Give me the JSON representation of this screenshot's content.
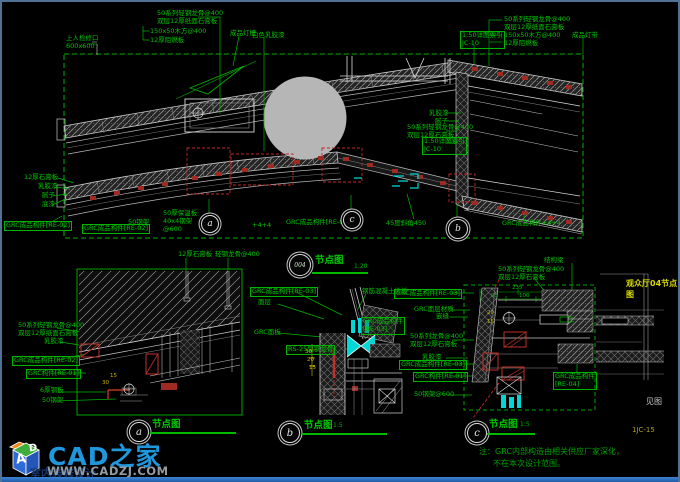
{
  "page": {
    "bg": "#000000",
    "border_color": "#4f7296",
    "bottom_bar_color": "#2e72c0",
    "line_green": "#00c400",
    "line_white": "#d8d8d8",
    "highlight_red": "#c02828",
    "cyan": "#00d8d8",
    "circle_gray": "#b6b6b6"
  },
  "sheet": {
    "title_tag": "观众厅04节点图",
    "ref_text": "见图",
    "sheet_no": "1JC-15"
  },
  "note": {
    "line1": "注：GRC内部构造由相关供应厂家深化，",
    "line2": "不在本次设计范围。"
  },
  "watermark": {
    "brand": "CAD之家",
    "url": "WWW.CADZJ.COM",
    "sub": "室内装修设计",
    "cube_letter_a": "A",
    "cube_letter_d": "D"
  },
  "details": [
    {
      "id": "004",
      "title": "节点图",
      "scale": "1:20",
      "cx": 297,
      "cy": 262,
      "r": 10,
      "tx": 313,
      "ty": 254,
      "sx": 352,
      "sy": 262,
      "ux": 310,
      "uy": 270,
      "uw": 56,
      "letter_size": 6,
      "letter_color": "#cfe8cf"
    },
    {
      "id": "a",
      "title": "节点图",
      "scale": "",
      "cx": 136,
      "cy": 429,
      "r": 9,
      "tx": 150,
      "ty": 418,
      "sx": 0,
      "sy": 0,
      "ux": 148,
      "uy": 430,
      "uw": 86,
      "letter_size": 10,
      "letter_color": "#e6e6e6"
    },
    {
      "id": "b",
      "title": "节点图",
      "scale": "1:5",
      "cx": 287,
      "cy": 430,
      "r": 9,
      "tx": 302,
      "ty": 419,
      "sx": 331,
      "sy": 421,
      "ux": 300,
      "uy": 431,
      "uw": 85,
      "letter_size": 10,
      "letter_color": "#e6e6e6"
    },
    {
      "id": "c",
      "title": "节点图",
      "scale": "1:5",
      "cx": 474,
      "cy": 430,
      "r": 9,
      "tx": 487,
      "ty": 418,
      "sx": 518,
      "sy": 420,
      "ux": 485,
      "uy": 431,
      "uw": 48,
      "letter_size": 10,
      "letter_color": "#e6e6e6"
    }
  ],
  "markers": [
    {
      "l": "a",
      "x": 207,
      "y": 221,
      "r": 8
    },
    {
      "l": "c",
      "x": 349,
      "y": 217,
      "r": 8
    },
    {
      "l": "b",
      "x": 455,
      "y": 226,
      "r": 9
    }
  ],
  "annotations": [
    {
      "t": "50系列轻钢龙骨@400\n双层12厚纸面石膏板",
      "x": 155,
      "y": 8
    },
    {
      "t": "150x50木方@400",
      "x": 148,
      "y": 26
    },
    {
      "t": "12厚阻燃板",
      "x": 148,
      "y": 35
    },
    {
      "t": "成品灯槽",
      "x": 228,
      "y": 28
    },
    {
      "t": "白色乳胶漆",
      "x": 250,
      "y": 30
    },
    {
      "t": "上人检修口\n600x600",
      "x": 64,
      "y": 33
    },
    {
      "t": "50系列轻钢龙骨@400\n双层12厚纸面石膏板",
      "x": 502,
      "y": 14
    },
    {
      "t": "150x50木方@400",
      "x": 502,
      "y": 30
    },
    {
      "t": "12厚阻燃板",
      "x": 502,
      "y": 38
    },
    {
      "t": "1:50详图索引\nJC-10",
      "x": 458,
      "y": 29,
      "box": true
    },
    {
      "t": "成品灯带",
      "x": 570,
      "y": 30
    },
    {
      "t": "乳胶漆",
      "x": 427,
      "y": 108
    },
    {
      "t": "腻子",
      "x": 433,
      "y": 116
    },
    {
      "t": "50系列轻钢龙骨@400\n双层12厚石膏板",
      "x": 405,
      "y": 122
    },
    {
      "t": "1:50详图索引\nJC-10",
      "x": 420,
      "y": 135,
      "box": true
    },
    {
      "t": "12厚石膏板",
      "x": 22,
      "y": 172
    },
    {
      "t": "乳胶漆",
      "x": 36,
      "y": 181
    },
    {
      "t": "腻子",
      "x": 40,
      "y": 190
    },
    {
      "t": "底漆",
      "x": 40,
      "y": 199
    },
    {
      "t": "GRC成品构件[RE-02]",
      "x": 2,
      "y": 219,
      "box": true
    },
    {
      "t": "GRC成品构件[RE-02]",
      "x": 80,
      "y": 222,
      "box": true
    },
    {
      "t": "50钢架",
      "x": 126,
      "y": 217
    },
    {
      "t": "50厚保温板\n40x4钢架\n@600",
      "x": 161,
      "y": 208
    },
    {
      "t": "+4+4",
      "x": 250,
      "y": 220
    },
    {
      "t": "GRC成品构件[RE-01]",
      "x": 284,
      "y": 217
    },
    {
      "t": "45度斜角450",
      "x": 384,
      "y": 218
    },
    {
      "t": "GRC成品构件+4+4",
      "x": 500,
      "y": 218
    },
    {
      "t": "50系列轻钢龙骨@400\n双层12厚纸面石膏板",
      "x": 16,
      "y": 320
    },
    {
      "t": "乳胶漆",
      "x": 42,
      "y": 336
    },
    {
      "t": "GRC成品构件[RE-02]",
      "x": 10,
      "y": 354,
      "box": true
    },
    {
      "t": "GRC构件[RE-01]",
      "x": 24,
      "y": 367,
      "box": true
    },
    {
      "t": "6厚钢板",
      "x": 38,
      "y": 385
    },
    {
      "t": "50钢架",
      "x": 40,
      "y": 395
    },
    {
      "t": "12厚石膏板",
      "x": 176,
      "y": 249
    },
    {
      "t": "轻钢龙骨@400",
      "x": 213,
      "y": 249
    },
    {
      "t": "GRC成品构件[RE-03]",
      "x": 248,
      "y": 285,
      "box": true
    },
    {
      "t": "钢筋混凝土楼板",
      "x": 360,
      "y": 286
    },
    {
      "t": "GRC成品构件\n[RE-03]",
      "x": 359,
      "y": 315,
      "box": true
    },
    {
      "t": "面层",
      "x": 256,
      "y": 297
    },
    {
      "t": "GRC面板",
      "x": 252,
      "y": 327
    },
    {
      "t": "RS-25型钢龙骨",
      "x": 284,
      "y": 343,
      "box": true
    },
    {
      "t": "30",
      "x": 303,
      "y": 347,
      "c": "y",
      "s": 5.5
    },
    {
      "t": "20",
      "x": 305,
      "y": 355,
      "c": "y",
      "s": 5.5
    },
    {
      "t": "15",
      "x": 307,
      "y": 363,
      "c": "y",
      "s": 5.5
    },
    {
      "t": "15",
      "x": 108,
      "y": 371,
      "c": "y",
      "s": 5.5
    },
    {
      "t": "30",
      "x": 100,
      "y": 378,
      "c": "y",
      "s": 5.5
    },
    {
      "t": "GRC成品构件[RE-03]",
      "x": 392,
      "y": 287,
      "box": true
    },
    {
      "t": "GRC面层材质",
      "x": 412,
      "y": 304
    },
    {
      "t": "嵌缝",
      "x": 434,
      "y": 311
    },
    {
      "t": "50系列龙骨@400\n双层12厚石膏板",
      "x": 408,
      "y": 331
    },
    {
      "t": "乳胶漆",
      "x": 420,
      "y": 352
    },
    {
      "t": "GRC成品构件[RE-03]",
      "x": 397,
      "y": 358,
      "box": true
    },
    {
      "t": "GRC构件[RE-01]",
      "x": 411,
      "y": 370,
      "box": true
    },
    {
      "t": "50钢架@600",
      "x": 412,
      "y": 389
    },
    {
      "t": "结构梁",
      "x": 542,
      "y": 255
    },
    {
      "t": "50系列轻钢龙骨@400\n双层12厚石膏板",
      "x": 496,
      "y": 264
    },
    {
      "t": "235",
      "x": 510,
      "y": 283,
      "s": 5.5
    },
    {
      "t": "95",
      "x": 489,
      "y": 291,
      "s": 5.5
    },
    {
      "t": "100",
      "x": 517,
      "y": 291,
      "s": 5.5
    },
    {
      "t": "20",
      "x": 485,
      "y": 308,
      "c": "y",
      "s": 5.5
    },
    {
      "t": "15",
      "x": 485,
      "y": 317,
      "c": "y",
      "s": 5.5
    },
    {
      "t": "GRC成品构件\n[RE-04]",
      "x": 551,
      "y": 370,
      "box": true
    }
  ]
}
